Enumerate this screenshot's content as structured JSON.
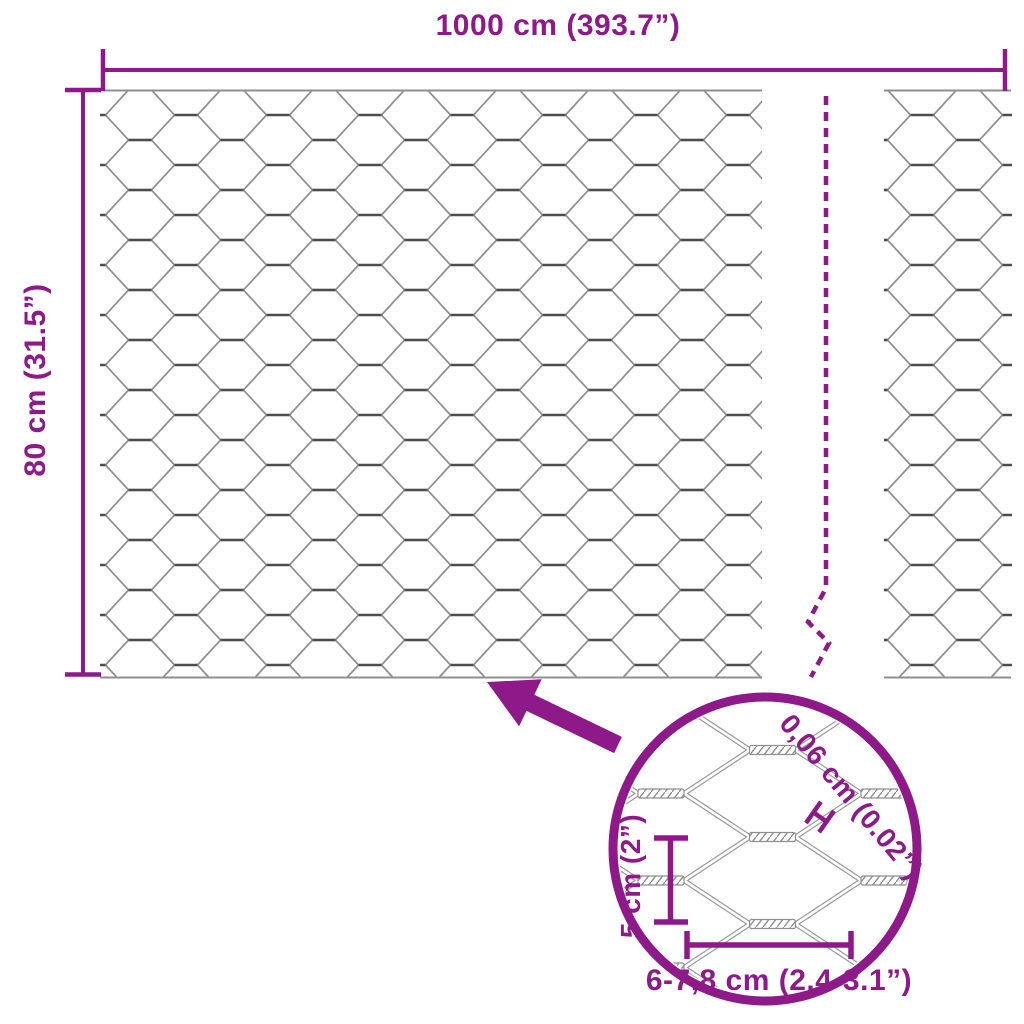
{
  "diagram": {
    "product": "hexagonal-wire-mesh",
    "top_dimension": {
      "label": "1000 cm (393.7”)"
    },
    "side_dimension": {
      "label": "80 cm (31.5”)"
    },
    "detail_view": {
      "wire_thickness_label": "0,06 cm (0.02”)",
      "cell_height_label": "5 cm (2”)",
      "cell_width_label": "6-7,8 cm (2.4-3.1”)"
    },
    "colors": {
      "accent": "#8E1988",
      "wire_dark": "#4D4D4D",
      "wire_light": "#8F8F8F"
    }
  }
}
